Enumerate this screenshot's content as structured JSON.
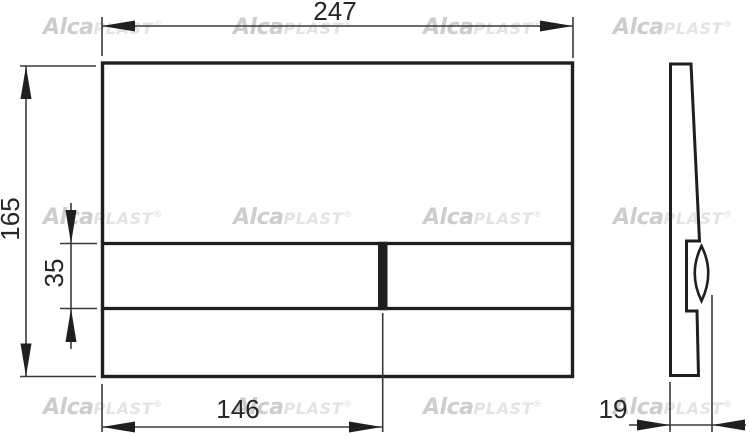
{
  "drawing_title": "flush-plate-dimension-drawing",
  "watermark": {
    "alca": "Alca",
    "plast": "PLAST",
    "reg": "®"
  },
  "dimensions": {
    "width_top": "247",
    "height_left": "165",
    "button_strip_height": "35",
    "button_width_bottom": "146",
    "depth_side": "19"
  },
  "colors": {
    "line": "#1f1f1f",
    "thin_line": "#3a3a3a",
    "dimension_text": "#262626",
    "watermark_bold": "#cdcdcd",
    "watermark_light": "#e3e3e3",
    "background": "#ffffff"
  }
}
